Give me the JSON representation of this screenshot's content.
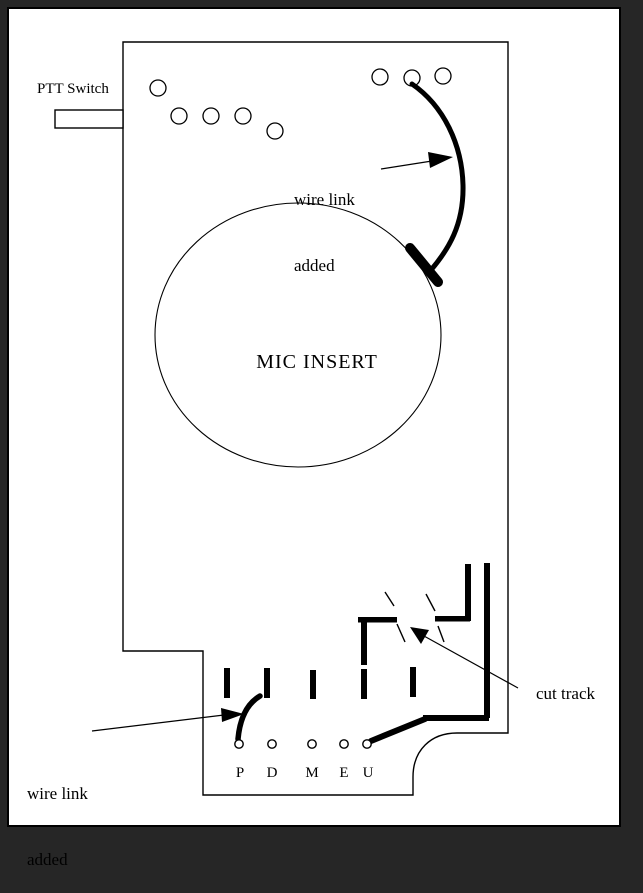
{
  "frame": {
    "background_color": "#262626",
    "paper_color": "#ffffff",
    "ink_color": "#000000"
  },
  "labels": {
    "ptt_switch": "PTT Switch",
    "top_wire_link_line1": "wire link",
    "top_wire_link_line2": "added",
    "mic_insert": "MIC INSERT",
    "bottom_wire_link_line1": "wire link",
    "bottom_wire_link_line2": "added",
    "cut_track": "cut track"
  },
  "pad_labels": [
    "P",
    "D",
    "M",
    "E",
    "U"
  ]
}
